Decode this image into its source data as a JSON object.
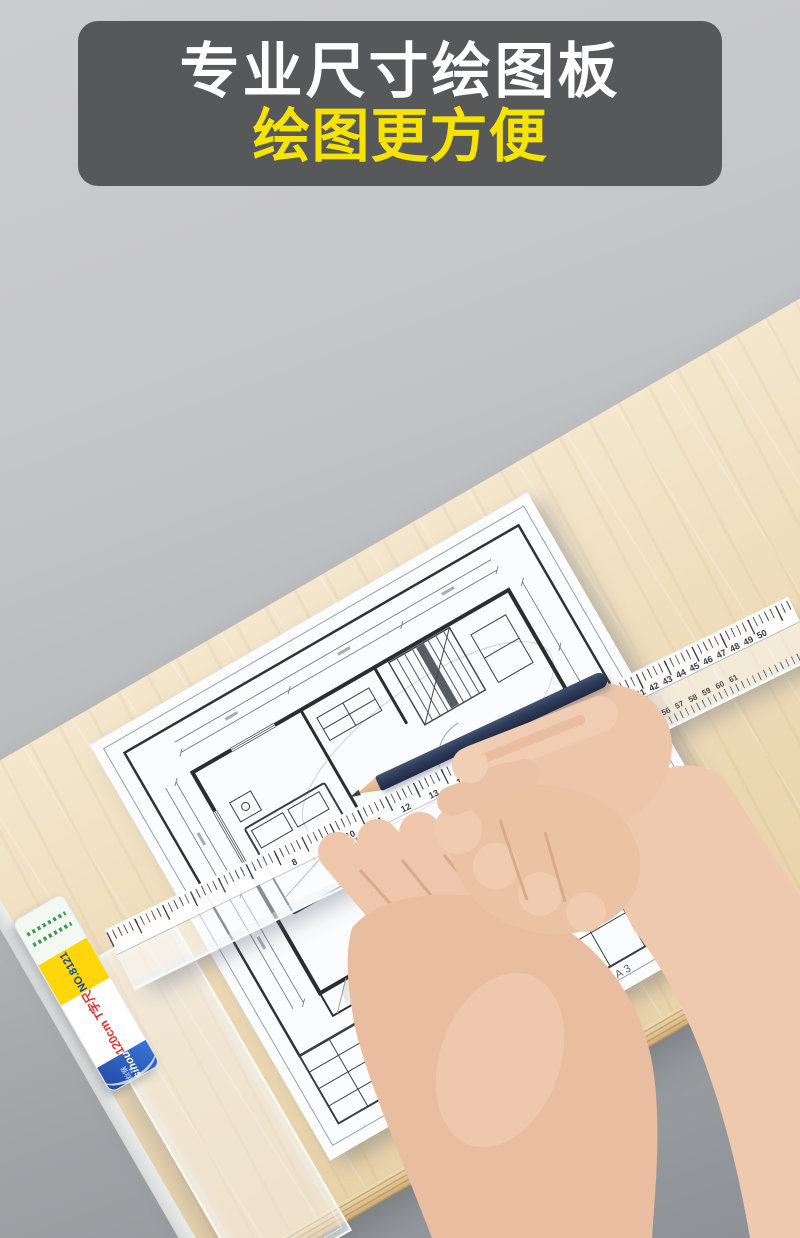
{
  "banner": {
    "title": "专业尺寸绘图板",
    "subtitle": "绘图更方便"
  },
  "colors": {
    "banner_bg": "#57585a",
    "banner_title": "#ffffff",
    "banner_subtitle": "#f6e400",
    "background_top": "#cbccce",
    "background_bottom": "#8d9195",
    "wood": "#eedcba",
    "paper": "#fbfcfd",
    "pencil_body": "#2f3d5c",
    "skin": "#ecc3a7",
    "label_yellow": "#ffd60a",
    "label_blue": "#1c3f96",
    "label_red": "#e03131"
  },
  "tsquare_label": {
    "brand": "Jinsihou",
    "brand_cn": "金丝猴",
    "size_text": "120cm",
    "product_text": "T字尺",
    "model_text": "NO.8121"
  },
  "ruler": {
    "scales": [
      {
        "name": "top-near",
        "start": 8,
        "end": 17,
        "step": 1,
        "spacing": 31,
        "offset": 200,
        "row": "top"
      },
      {
        "name": "top-far",
        "start": 40,
        "end": 50,
        "step": 1,
        "spacing": 15,
        "offset": 570,
        "row": "top"
      },
      {
        "name": "bottom-far",
        "start": 56,
        "end": 61,
        "step": 1,
        "spacing": 15,
        "offset": 600,
        "row": "bottom"
      }
    ]
  },
  "sheet": {
    "size_label": "A3",
    "room_labels": [
      "卧室",
      "卫生间"
    ]
  }
}
